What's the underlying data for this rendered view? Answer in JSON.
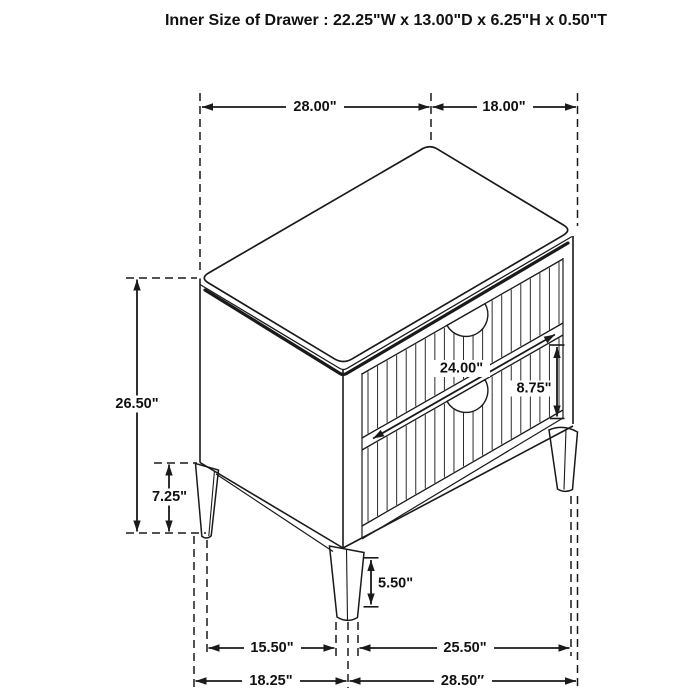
{
  "title": "Inner Size of Drawer : 22.25\"W x 13.00\"D x 6.25\"H x 0.50\"T",
  "dimensions": {
    "top_width": "28.00\"",
    "top_depth": "18.00\"",
    "overall_height": "26.50\"",
    "base_height": "7.25\"",
    "drawer_width": "24.00\"",
    "drawer_height": "8.75\"",
    "leg_height": "5.50\"",
    "leg_spacing_side": "15.50\"",
    "leg_spacing_front": "25.50\"",
    "base_depth": "18.25\"",
    "base_width": "28.50″"
  },
  "colors": {
    "line": "#1a1a1a",
    "text": "#111111",
    "background": "#ffffff"
  }
}
